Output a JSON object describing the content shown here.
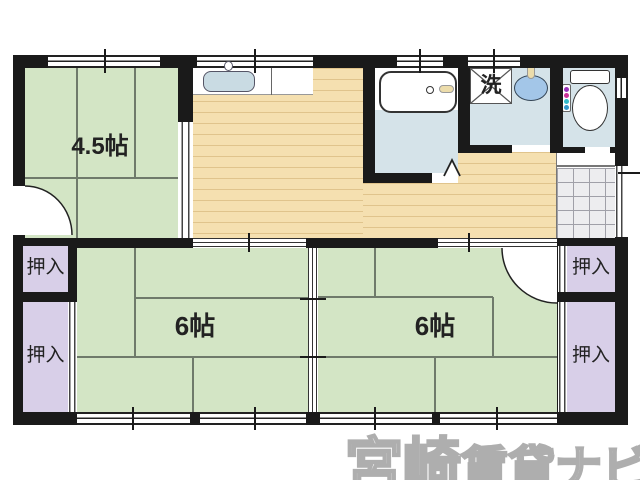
{
  "plan_title": "floor-plan",
  "rooms": {
    "room_45": {
      "label": "4.5帖",
      "type": "tatami"
    },
    "room_6_left": {
      "label": "6帖",
      "type": "tatami"
    },
    "room_6_right": {
      "label": "6帖",
      "type": "tatami"
    },
    "washer_space": {
      "label": "洗"
    },
    "closets": [
      {
        "label": "押入"
      },
      {
        "label": "押入"
      },
      {
        "label": "押入"
      },
      {
        "label": "押入"
      }
    ]
  },
  "watermark": {
    "bold_part": "宮崎",
    "light_part": "賃貸ナビ"
  },
  "colors": {
    "tatami_green": "#d3e5c5",
    "wood_floor": "#f5e0b0",
    "closet_purple": "#d8cfe8",
    "wet_area_blue": "#d5e3e9",
    "fixture_blue": "#a3c6e8",
    "wall_black": "#1a1a1a"
  }
}
